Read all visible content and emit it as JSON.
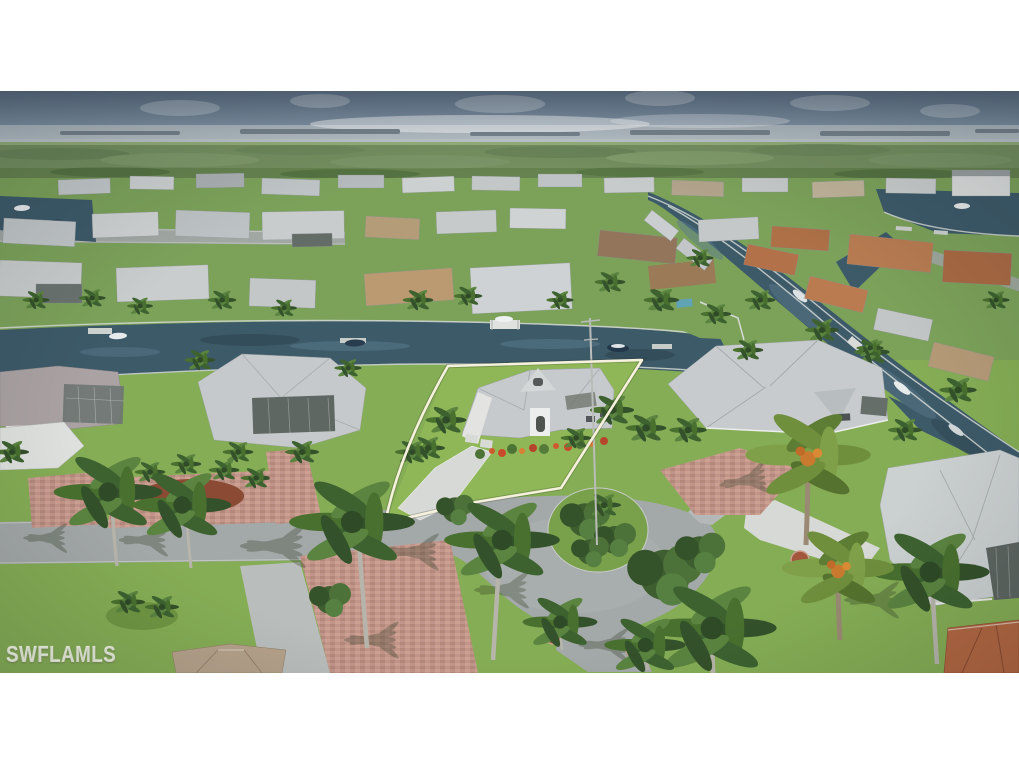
{
  "photo": {
    "watermark": "SWFLAMLS",
    "alt": "Aerial drone view of a waterfront Florida neighborhood with canals and palm trees; the listed home's lot is outlined in white beside a cul-de-sac lined with royal palms",
    "palette": {
      "letterbox": "#ffffff",
      "sky-top": "#66798e",
      "sky-horizon": "#9fb0bb",
      "distant-water": "#b3bdc4",
      "island-strip": "#77848e",
      "mangrove": "#66834f",
      "lawn-mid": "#7ca25a",
      "lawn-foreground": "#85ad55",
      "subject-lawn": "#8fb757",
      "canal-water": "#3d5a69",
      "road-asphalt": "#a3a8a8",
      "concrete-drive": "#d7d9d6",
      "paver-brick": "#c2958a",
      "roof-gray": "#c6cacc",
      "roof-tan": "#b49c79",
      "roof-brown": "#93755b",
      "roof-terracotta": "#b26742",
      "palm-frond": "#49702f",
      "palm-trunk": "#b7b5ab",
      "property-outline": "#f6f1dc",
      "watermark-text": "rgba(248,248,242,0.62)"
    }
  }
}
